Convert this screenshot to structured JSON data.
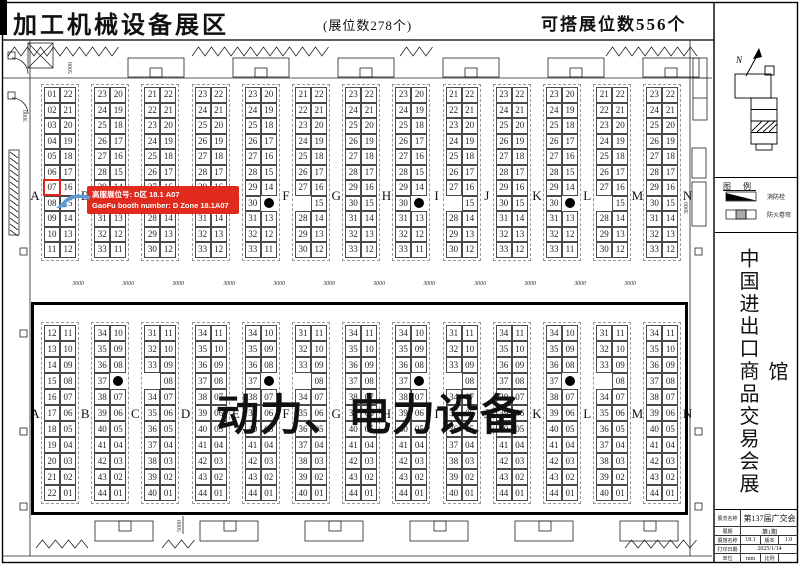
{
  "header": {
    "title": "加工机械设备展区",
    "booth_count_note": "(展位数278个)",
    "buildable_note": "可搭展位数556个"
  },
  "callout": {
    "line1": "高服展位号: D区 18.1 A07",
    "line2": "GaoFu booth number: D Zone 18.1A07",
    "highlighted_booth": "07",
    "highlighted_zone": "A"
  },
  "big_label": "动力、电力设备",
  "zones": [
    "A",
    "B",
    "C",
    "D",
    "E",
    "F",
    "G",
    "H",
    "I",
    "J",
    "K",
    "L",
    "M",
    "N"
  ],
  "top_section": {
    "grids": [
      {
        "left": [
          "01",
          "02",
          "03",
          "04",
          "05",
          "06",
          "07",
          "08",
          "09",
          "10",
          "11"
        ],
        "right": [
          "22",
          "21",
          "20",
          "19",
          "18",
          "17",
          "16",
          "15",
          "14",
          "13",
          "12"
        ]
      },
      {
        "left": [
          "23",
          "24",
          "25",
          "26",
          "27",
          "28",
          "29",
          "30",
          "31",
          "32",
          "33"
        ],
        "right": [
          "20",
          "19",
          "18",
          "17",
          "16",
          "15",
          "14",
          "",
          "13",
          "12",
          "11"
        ]
      },
      {
        "left": [
          "21",
          "22",
          "23",
          "24",
          "25",
          "26",
          "27",
          "",
          "28",
          "29",
          "30"
        ],
        "right": [
          "22",
          "21",
          "20",
          "19",
          "18",
          "17",
          "16",
          "15",
          "14",
          "13",
          "12"
        ]
      },
      {
        "left": [
          "23",
          "24",
          "25",
          "26",
          "27",
          "28",
          "29",
          "30",
          "31",
          "32",
          "33"
        ],
        "right": [
          "22",
          "21",
          "20",
          "19",
          "18",
          "17",
          "16",
          "15",
          "14",
          "13",
          "12"
        ]
      },
      {
        "left": [
          "23",
          "24",
          "25",
          "26",
          "27",
          "28",
          "29",
          "30",
          "31",
          "32",
          "33"
        ],
        "right": [
          "20",
          "19",
          "18",
          "17",
          "16",
          "15",
          "14",
          "",
          "13",
          "12",
          "11"
        ]
      },
      {
        "left": [
          "21",
          "22",
          "23",
          "24",
          "25",
          "26",
          "27",
          "",
          "28",
          "29",
          "30"
        ],
        "right": [
          "22",
          "21",
          "20",
          "19",
          "18",
          "17",
          "16",
          "15",
          "14",
          "13",
          "12"
        ]
      },
      {
        "left": [
          "23",
          "24",
          "25",
          "26",
          "27",
          "28",
          "29",
          "30",
          "31",
          "32",
          "33"
        ],
        "right": [
          "22",
          "21",
          "20",
          "19",
          "18",
          "17",
          "16",
          "15",
          "14",
          "13",
          "12"
        ]
      },
      {
        "left": [
          "23",
          "24",
          "25",
          "26",
          "27",
          "28",
          "29",
          "30",
          "31",
          "32",
          "33"
        ],
        "right": [
          "20",
          "19",
          "18",
          "17",
          "16",
          "15",
          "14",
          "",
          "13",
          "12",
          "11"
        ]
      },
      {
        "left": [
          "21",
          "22",
          "23",
          "24",
          "25",
          "26",
          "27",
          "",
          "28",
          "29",
          "30"
        ],
        "right": [
          "22",
          "21",
          "20",
          "19",
          "18",
          "17",
          "16",
          "15",
          "14",
          "13",
          "12"
        ]
      },
      {
        "left": [
          "23",
          "24",
          "25",
          "26",
          "27",
          "28",
          "29",
          "30",
          "31",
          "32",
          "33"
        ],
        "right": [
          "22",
          "21",
          "20",
          "19",
          "18",
          "17",
          "16",
          "15",
          "14",
          "13",
          "12"
        ]
      },
      {
        "left": [
          "23",
          "24",
          "25",
          "26",
          "27",
          "28",
          "29",
          "30",
          "31",
          "32",
          "33"
        ],
        "right": [
          "20",
          "19",
          "18",
          "17",
          "16",
          "15",
          "14",
          "",
          "13",
          "12",
          "11"
        ]
      },
      {
        "left": [
          "21",
          "22",
          "23",
          "24",
          "25",
          "26",
          "27",
          "",
          "28",
          "29",
          "30"
        ],
        "right": [
          "22",
          "21",
          "20",
          "19",
          "18",
          "17",
          "16",
          "15",
          "14",
          "13",
          "12"
        ]
      },
      {
        "left": [
          "23",
          "24",
          "25",
          "26",
          "27",
          "28",
          "29",
          "30",
          "31",
          "32",
          "33"
        ],
        "right": [
          "22",
          "21",
          "20",
          "19",
          "18",
          "17",
          "16",
          "15",
          "14",
          "13",
          "12"
        ]
      }
    ]
  },
  "bottom_section": {
    "grids": [
      {
        "left": [
          "12",
          "13",
          "14",
          "15",
          "16",
          "17",
          "18",
          "19",
          "20",
          "21",
          "22"
        ],
        "right": [
          "11",
          "10",
          "09",
          "08",
          "07",
          "06",
          "05",
          "04",
          "03",
          "02",
          "01"
        ]
      },
      {
        "left": [
          "34",
          "35",
          "36",
          "37",
          "38",
          "39",
          "40",
          "41",
          "42",
          "43",
          "44"
        ],
        "right": [
          "10",
          "09",
          "08",
          "",
          "07",
          "06",
          "05",
          "04",
          "03",
          "02",
          "01"
        ]
      },
      {
        "left": [
          "31",
          "32",
          "33",
          "",
          "34",
          "35",
          "36",
          "37",
          "38",
          "39",
          "40"
        ],
        "right": [
          "11",
          "10",
          "09",
          "08",
          "07",
          "06",
          "05",
          "04",
          "03",
          "02",
          "01"
        ]
      },
      {
        "left": [
          "34",
          "35",
          "36",
          "37",
          "38",
          "39",
          "40",
          "41",
          "42",
          "43",
          "44"
        ],
        "right": [
          "11",
          "10",
          "09",
          "08",
          "07",
          "06",
          "05",
          "04",
          "03",
          "02",
          "01"
        ]
      },
      {
        "left": [
          "34",
          "35",
          "36",
          "37",
          "38",
          "39",
          "40",
          "41",
          "42",
          "43",
          "44"
        ],
        "right": [
          "10",
          "09",
          "08",
          "",
          "07",
          "06",
          "05",
          "04",
          "03",
          "02",
          "01"
        ]
      },
      {
        "left": [
          "31",
          "32",
          "33",
          "",
          "34",
          "35",
          "36",
          "37",
          "38",
          "39",
          "40"
        ],
        "right": [
          "11",
          "10",
          "09",
          "08",
          "07",
          "06",
          "05",
          "04",
          "03",
          "02",
          "01"
        ]
      },
      {
        "left": [
          "34",
          "35",
          "36",
          "37",
          "38",
          "39",
          "40",
          "41",
          "42",
          "43",
          "44"
        ],
        "right": [
          "11",
          "10",
          "09",
          "08",
          "07",
          "06",
          "05",
          "04",
          "03",
          "02",
          "01"
        ]
      },
      {
        "left": [
          "34",
          "35",
          "36",
          "37",
          "38",
          "39",
          "40",
          "41",
          "42",
          "43",
          "44"
        ],
        "right": [
          "10",
          "09",
          "08",
          "",
          "07",
          "06",
          "05",
          "04",
          "03",
          "02",
          "01"
        ]
      },
      {
        "left": [
          "31",
          "32",
          "33",
          "",
          "34",
          "35",
          "36",
          "37",
          "38",
          "39",
          "40"
        ],
        "right": [
          "11",
          "10",
          "09",
          "08",
          "07",
          "06",
          "05",
          "04",
          "03",
          "02",
          "01"
        ]
      },
      {
        "left": [
          "34",
          "35",
          "36",
          "37",
          "38",
          "39",
          "40",
          "41",
          "42",
          "43",
          "44"
        ],
        "right": [
          "11",
          "10",
          "09",
          "08",
          "07",
          "06",
          "05",
          "04",
          "03",
          "02",
          "01"
        ]
      },
      {
        "left": [
          "34",
          "35",
          "36",
          "37",
          "38",
          "39",
          "40",
          "41",
          "42",
          "43",
          "44"
        ],
        "right": [
          "10",
          "09",
          "08",
          "",
          "07",
          "06",
          "05",
          "04",
          "03",
          "02",
          "01"
        ]
      },
      {
        "left": [
          "31",
          "32",
          "33",
          "",
          "34",
          "35",
          "36",
          "37",
          "38",
          "39",
          "40"
        ],
        "right": [
          "11",
          "10",
          "09",
          "08",
          "07",
          "06",
          "05",
          "04",
          "03",
          "02",
          "01"
        ]
      },
      {
        "left": [
          "34",
          "35",
          "36",
          "37",
          "38",
          "39",
          "40",
          "41",
          "42",
          "43",
          "44"
        ],
        "right": [
          "11",
          "10",
          "09",
          "08",
          "07",
          "06",
          "05",
          "04",
          "03",
          "02",
          "01"
        ]
      }
    ]
  },
  "pillar_dots": {
    "top": {
      "grid_indices": [
        1,
        4,
        7,
        10
      ],
      "row_index": 7
    },
    "bottom": {
      "grid_indices": [
        1,
        4,
        7,
        10
      ],
      "row_index": 3
    }
  },
  "dimensions": {
    "aisle": "3000",
    "top_wall": "5000",
    "bottom_wall": "5000",
    "side": "3000",
    "left": "3000"
  },
  "colors": {
    "callout_bg": "#e02a1e",
    "highlight": "#e0241b",
    "arrow": "#5b9bd5"
  },
  "sidebar": {
    "compass": "N",
    "legend": {
      "title": "图 例",
      "items": [
        {
          "symbol": "fire-hydrant",
          "label": "消防栓"
        },
        {
          "symbol": "fire-shutter",
          "label": "防火卷帘"
        }
      ]
    },
    "hall_title": "中国进出口商品交易会展馆",
    "title_block": {
      "r1": {
        "label": "展览名称",
        "value": "第137届广交会"
      },
      "r2": {
        "label": "展期",
        "value": "第1期"
      },
      "r3": {
        "label": "展馆名称",
        "value": "18.1",
        "label2": "版本",
        "value2": "1.0"
      },
      "r4": {
        "label": "打印日期",
        "value": "2025/1/14"
      },
      "r5": {
        "label": "单位",
        "value": "mm",
        "label2": "比例",
        "value2": ""
      }
    }
  }
}
